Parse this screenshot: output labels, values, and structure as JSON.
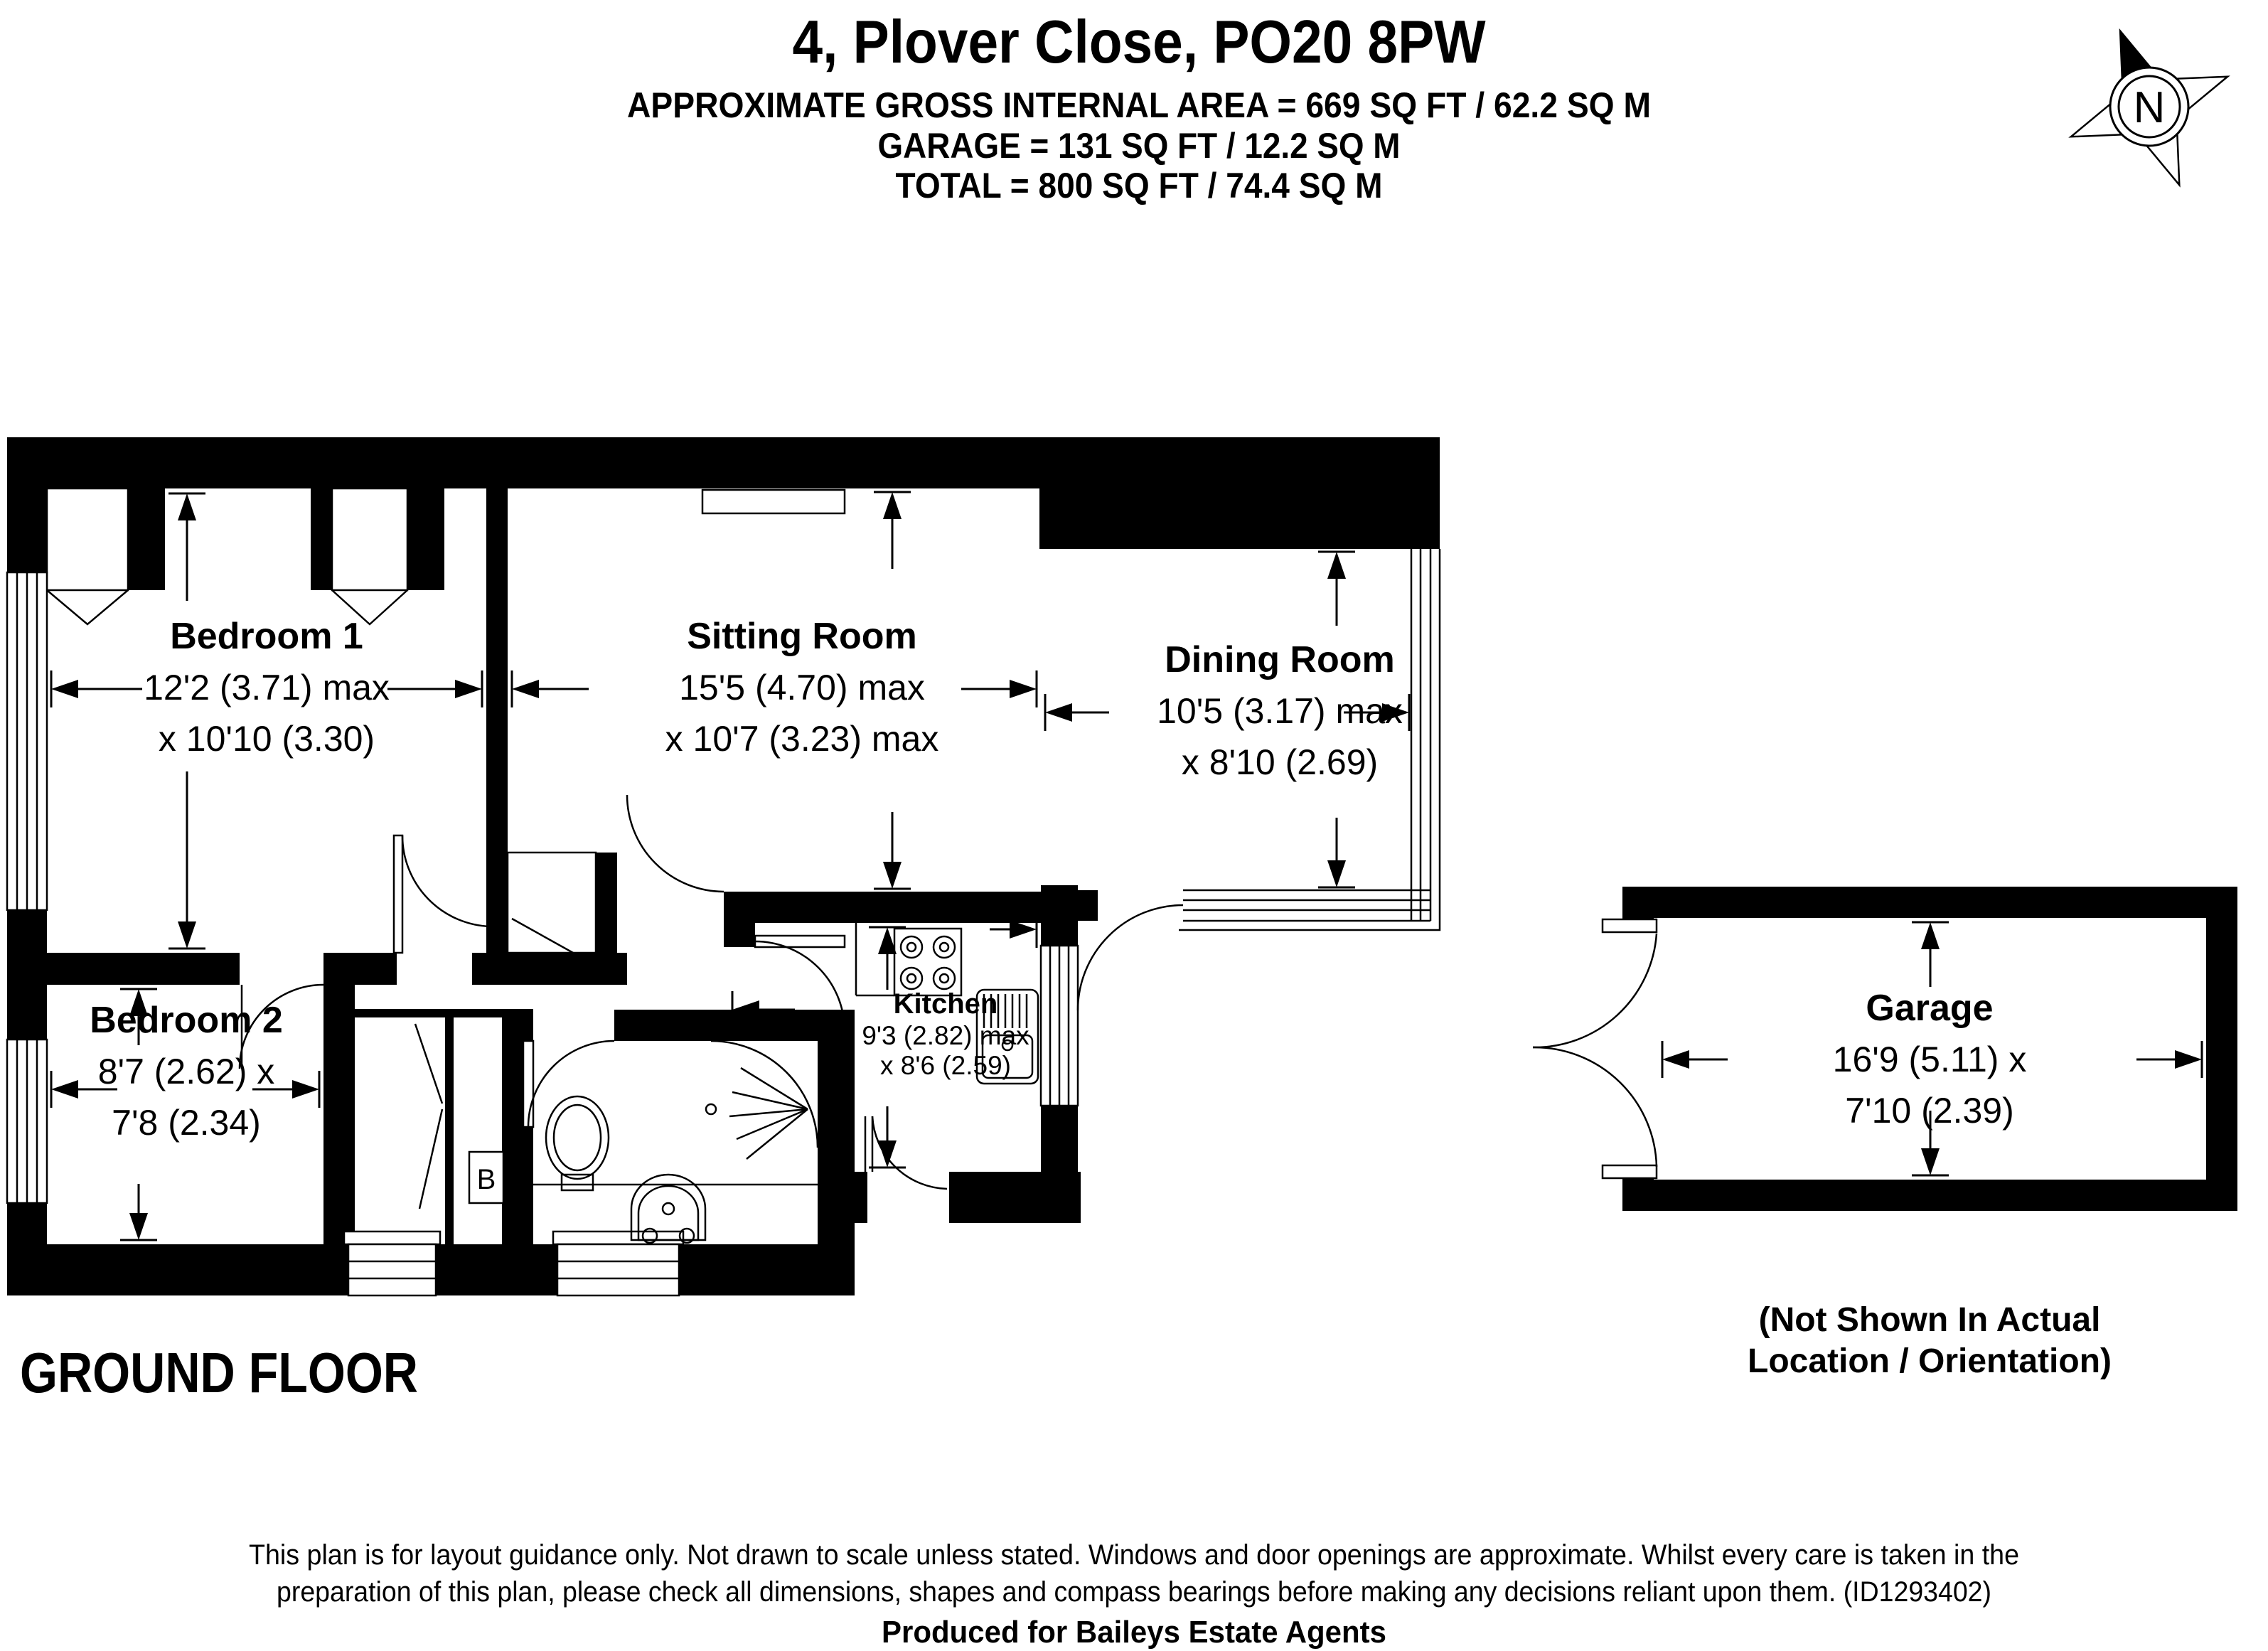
{
  "header": {
    "title": "4, Plover Close, PO20 8PW",
    "area_line": "APPROXIMATE GROSS INTERNAL AREA = 669 SQ FT / 62.2 SQ M",
    "garage_line": "GARAGE = 131 SQ FT / 12.2 SQ M",
    "total_line": "TOTAL = 800 SQ FT / 74.4 SQ M"
  },
  "compass": {
    "north_label": "N"
  },
  "floor_label": "GROUND FLOOR",
  "rooms": {
    "bedroom1": {
      "name": "Bedroom 1",
      "dim1": "12'2 (3.71) max",
      "dim2": "x 10'10 (3.30)"
    },
    "sitting": {
      "name": "Sitting Room",
      "dim1": "15'5 (4.70) max",
      "dim2": "x 10'7 (3.23) max"
    },
    "dining": {
      "name": "Dining Room",
      "dim1": "10'5 (3.17) max",
      "dim2": "x 8'10 (2.69)"
    },
    "bedroom2": {
      "name": "Bedroom 2",
      "dim1": "8'7 (2.62) x",
      "dim2": "7'8 (2.34)"
    },
    "kitchen": {
      "name": "Kitchen",
      "dim1": "9'3 (2.82) max",
      "dim2": "x 8'6 (2.59)"
    },
    "garage": {
      "name": "Garage",
      "dim1": "16'9 (5.11) x",
      "dim2": "7'10 (2.39)"
    }
  },
  "garage_note": {
    "line1": "(Not Shown In Actual",
    "line2": "Location / Orientation)"
  },
  "boiler_label": "B",
  "footer": {
    "line1": "This plan is for layout guidance only. Not drawn to scale unless stated. Windows and door openings are approximate. Whilst every care is taken in the",
    "line2": "preparation of this plan, please check all dimensions, shapes and compass bearings before making any decisions reliant upon them. (ID1293402)",
    "credit": "Produced for Baileys Estate Agents"
  }
}
